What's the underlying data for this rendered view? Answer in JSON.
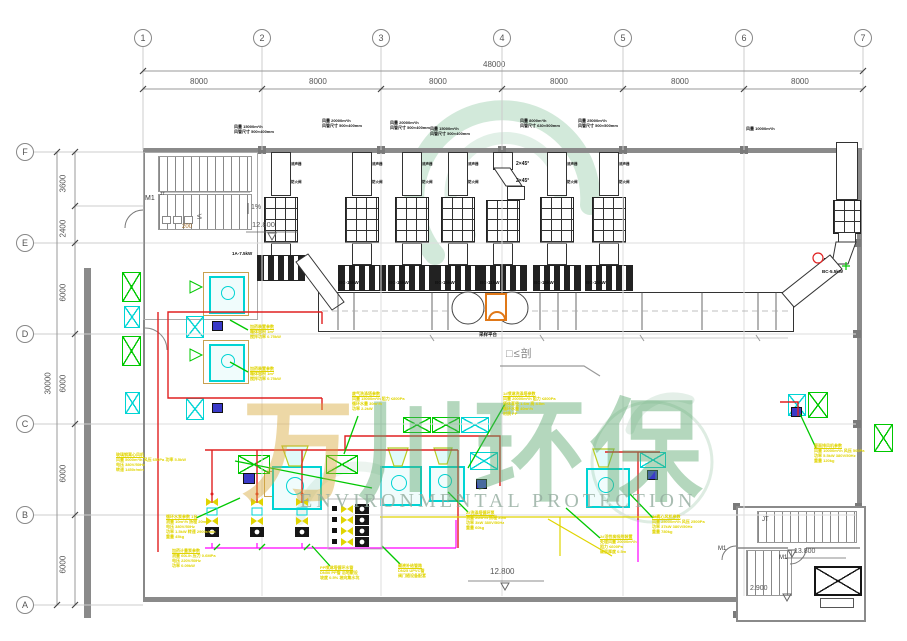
{
  "grid": {
    "cols": [
      "1",
      "2",
      "3",
      "4",
      "5",
      "6",
      "7"
    ],
    "rows": [
      "F",
      "E",
      "D",
      "C",
      "B",
      "A"
    ]
  },
  "dims": {
    "top_total": "48000",
    "top_bays": [
      "8000",
      "8000",
      "8000",
      "8000",
      "8000",
      "8000"
    ],
    "left_total": "30000",
    "left_segs": [
      "3600",
      "2400",
      "6000",
      "6000",
      "6000",
      "6000"
    ]
  },
  "stair_tl": {
    "door": "M1",
    "mark": "JT",
    "slope": "1%",
    "level": "12.800",
    "note": "200",
    "leq": "≤"
  },
  "stair_br": {
    "mark": "JT",
    "level_up": "13.800",
    "level_dn": "2.900",
    "door": "M1",
    "door2": "M1"
  },
  "levels": {
    "bottom_center": "12.800"
  },
  "section_mark": "□≤剖",
  "sampling_platform": "采样平台",
  "bend_notes": [
    "2×45°",
    "2×45°"
  ],
  "duct_markers": {
    "m1": "消声器",
    "m2": "防火阀"
  },
  "trains": [
    {
      "flow": "风量 15000m³/h",
      "size": "风管尺寸 500×400mm",
      "fan": "1A-7.5kW"
    },
    {
      "flow": "风量 20000m³/h",
      "size": "风管尺寸 500×400mm",
      "fan": "BC-15kW"
    },
    {
      "flow": "风量 20000m³/h",
      "size": "风管尺寸 500×400mm",
      "fan": "BC-15kW"
    },
    {
      "flow": "风量 15000m³/h",
      "size": "风管尺寸 500×400mm",
      "fan": "BC-15kW"
    },
    {
      "flow": "风量 8000m³/h",
      "size": "风管尺寸 630×500mm",
      "fan": "BC-11kW"
    },
    {
      "flow": "风量 25000m³/h",
      "size": "风管尺寸 500×500mm",
      "fan": "BC-15kW"
    },
    {
      "fan": "BC-15kW"
    }
  ],
  "right_stack": {
    "flow": "风量 10000m³/h",
    "fan": "BC-5.5kW"
  },
  "annotations": [
    {
      "lines": [
        "玻璃钢离心风机",
        "风量 5000m³/h 风压 650Pa 功率 5.5kW",
        "电压 380V/50Hz",
        "转速 1450r/min"
      ]
    },
    {
      "lines": [
        "循环水泵参数 1台",
        "流量 10m³/h 扬程 20m",
        "电压 380V/50Hz",
        "功率 1.5kW 转速 2900r/min",
        "重量 45kg"
      ]
    },
    {
      "lines": [
        "加药计量泵参数",
        "流量 60L/h 压力 0.6MPa",
        "电压 220V/50Hz",
        "功率 0.09kW"
      ]
    },
    {
      "lines": [
        "PP喷淋塔循环水管",
        "DN50 PP管 沿地敷设",
        "坡度 0.5% 坡向集水坑"
      ]
    },
    {
      "lines": [
        "碱液补给管路",
        "DN25 UPVC管",
        "阀门随设备配套"
      ]
    },
    {
      "lines": [
        "2#洗涤塔循环泵",
        "流量 20m³/h 扬程 25m",
        "功率 3kW 380V/50Hz",
        "重量 60kg"
      ]
    },
    {
      "lines": [
        "1#喷淋洗涤塔参数",
        "风量 20000m³/h 阻力 ≤800Pa",
        "塔体直径 1.6m 高 4.5m",
        "循环水量 40m³/h",
        "材质 PP"
      ]
    },
    {
      "lines": [
        "2#活性炭吸附装置",
        "处理风量 20000m³/h",
        "阻力 ≤600Pa",
        "碳层厚度 0.5m"
      ]
    },
    {
      "lines": [
        "3#离心风机参数",
        "风量 25000m³/h 风压 2500Pa",
        "功率 37kW 380V/50Hz",
        "重量 780kg"
      ]
    },
    {
      "lines": [
        "屋面排风机参数",
        "风量 10000m³/h 风压 500Pa",
        "功率 5.5kW 380V/50Hz",
        "重量 120kg"
      ]
    },
    {
      "lines": [
        "废气洗涤塔参数",
        "风量 15000m³/h 阻力 ≤800Pa",
        "循环水量 30m³/h",
        "功率 2.2kW"
      ]
    },
    {
      "lines": [
        "加药装置参数",
        "箱体容积 1m³",
        "搅拌功率 0.75kW"
      ]
    },
    {
      "lines": [
        "加药装置参数",
        "箱体容积 1m³",
        "搅拌功率 0.75kW"
      ]
    }
  ],
  "watermark": {
    "c1": "万",
    "c2": "川",
    "c3": "环",
    "c4": "保",
    "subtitle": "ENVIRONMENTAL PROTECTION"
  },
  "colors": {
    "pipe_red": "#e02020",
    "pipe_magenta": "#ff00ff",
    "pipe_yellow": "#e0d400",
    "leader_green": "#00c800",
    "damper_cyan": "#00d4d4",
    "sampling_orange": "#e07818"
  }
}
